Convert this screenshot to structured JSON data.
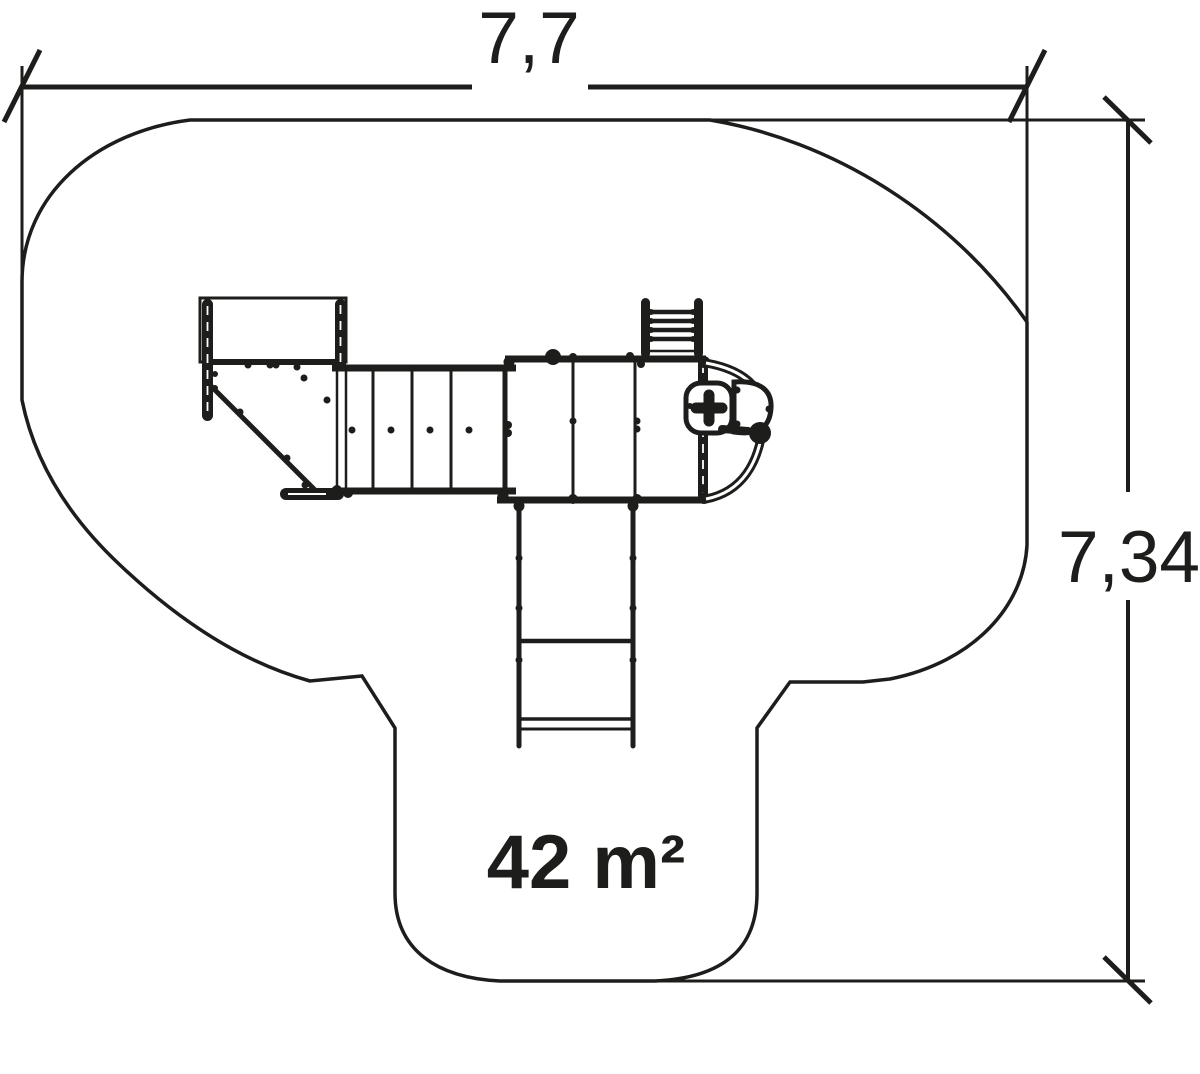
{
  "page": {
    "background_color": "#ffffff",
    "line_color": "#1d1d1b"
  },
  "dimensions": {
    "width_label": "7,7",
    "height_label": "7,34"
  },
  "area": {
    "label": "42 m²"
  }
}
